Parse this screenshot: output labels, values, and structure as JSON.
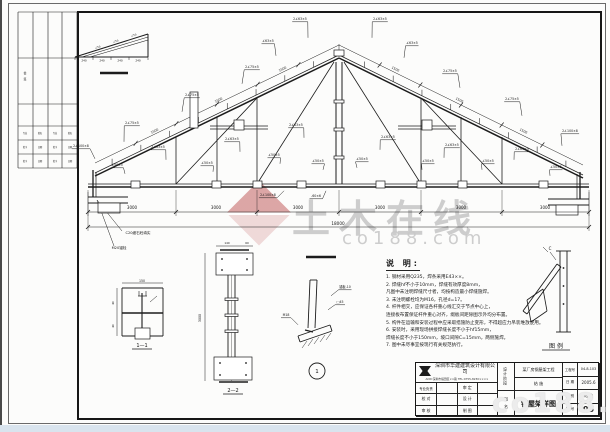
{
  "meta": {
    "sheet_no": "05",
    "drawing_title": "钢屋架详图",
    "source_watermark": "土木在线 co188.com"
  },
  "watermark": {
    "brand": "土木在线",
    "domain": "co188.com",
    "domain_bottom_right": "co188.com"
  },
  "notes": {
    "title": "说 明:",
    "lines": [
      "1. 钢材采用Q235，焊条采用E43××。",
      "2. 焊缝hf不小于10mm，焊缝有效厚度8mm，",
      "    凡图中未注明焊缝尺寸者，均按构造最小焊缝施焊。",
      "3. 未注明螺栓均为M16，孔径d=17。",
      "4. 杆件相交，应保证各杆重心线汇交于节点中心上，",
      "    连接板布置保证杆件重心对齐，缀板间距除图示外均分布置。",
      "5. 构件在运输和安装过程中应采取措施防止变形，不得超应力吊装堆放使用。",
      "6. 安装时，采用现场拼接焊缝长度不小于hf15mm，",
      "    焊缝长度不小于150mm，坡口间隙C=15mm，两侧施焊。",
      "7. 图中未尽事宜按现行有关规范执行。"
    ]
  },
  "title_block": {
    "company_name": "深圳市华建建筑设计有限公司",
    "company_info": "ADD:深圳市福田区××路 TEL:0755-8230××××",
    "roles": {
      "r0c0": "专业负责",
      "r0c1": "审 定",
      "r1c0": "校 对",
      "r1c1": "设 计",
      "r2c0": "审 核",
      "r2c1": "制 图"
    },
    "stage_label": "设计阶段",
    "name_label": "图 名",
    "project_name": "某厂房钢屋架工程",
    "stage_value": "结 施",
    "drawing_title": "钢屋架详图",
    "project_no_label": "工程号",
    "project_no": "04-8-103",
    "date_label": "日 期",
    "date": "2005.6",
    "category_label": "图 别",
    "category": "结 施",
    "sheet_label": "图 号",
    "sheet_no": "05"
  },
  "drawing": {
    "stroke": "#1c1c1c",
    "truss": {
      "apex": [
        339,
        58
      ],
      "eave_left": [
        95,
        176
      ],
      "eave_right": [
        583,
        178
      ],
      "bottom_y": 184,
      "bottom_x1": 88,
      "bottom_x2": 589,
      "king_x": 339
    },
    "webs": [
      [
        176,
        184,
        176,
        137
      ],
      [
        257,
        184,
        257,
        98
      ],
      [
        217,
        184,
        217,
        117
      ],
      [
        176,
        184,
        257,
        98
      ],
      [
        257,
        184,
        334,
        62
      ],
      [
        421,
        184,
        421,
        98
      ],
      [
        502,
        184,
        502,
        137
      ],
      [
        461,
        184,
        461,
        117
      ],
      [
        502,
        184,
        421,
        98
      ],
      [
        421,
        184,
        344,
        62
      ]
    ],
    "king_lines": [
      [
        336,
        62,
        336,
        184
      ],
      [
        342,
        62,
        342,
        184
      ]
    ],
    "extra_lines": [
      [
        88,
        197,
        128,
        197,
        1
      ],
      [
        88,
        203,
        128,
        203,
        1
      ],
      [
        93,
        170,
        93,
        197,
        1.3
      ],
      [
        96,
        172,
        96,
        197,
        0.7
      ],
      [
        548,
        199,
        589,
        199,
        1
      ],
      [
        548,
        205,
        589,
        205,
        1
      ],
      [
        580,
        172,
        580,
        199,
        1.3
      ],
      [
        577,
        174,
        577,
        199,
        0.7
      ],
      [
        210,
        126,
        268,
        126,
        0.7
      ],
      [
        210,
        129,
        268,
        129,
        0.7
      ],
      [
        398,
        126,
        456,
        126,
        0.7
      ],
      [
        398,
        129,
        456,
        129,
        0.7
      ],
      [
        100,
        73,
        128,
        73,
        2.6
      ],
      [
        306,
        257,
        336,
        257,
        2.6
      ],
      [
        339,
        44,
        339,
        57,
        0.5
      ],
      [
        97,
        200,
        122,
        231,
        0.5
      ],
      [
        97,
        200,
        114,
        246,
        0.5
      ],
      [
        75,
        57,
        148,
        57,
        1
      ],
      [
        148,
        34,
        148,
        57,
        1
      ],
      [
        75,
        57,
        148,
        34,
        1
      ],
      [
        82,
        57,
        148,
        37,
        0.55
      ],
      [
        90,
        57,
        148,
        40,
        0.55
      ],
      [
        75,
        57,
        75,
        60,
        0.5
      ],
      [
        93,
        57,
        93,
        60,
        0.5
      ],
      [
        111,
        57,
        111,
        60,
        0.5
      ],
      [
        129,
        57,
        129,
        60,
        0.5
      ],
      [
        148,
        57,
        148,
        60,
        0.5
      ],
      [
        122,
        288,
        163,
        288,
        0.9
      ],
      [
        163,
        288,
        163,
        336,
        0.9
      ],
      [
        122,
        336,
        163,
        336,
        0.9
      ],
      [
        122,
        288,
        122,
        336,
        0.9
      ],
      [
        142,
        293,
        142,
        336,
        1.1
      ],
      [
        122,
        313,
        163,
        313,
        1.6
      ],
      [
        139,
        291,
        139,
        296,
        0.6
      ],
      [
        146,
        291,
        146,
        296,
        0.6
      ],
      [
        138,
        296,
        147,
        296,
        0.7
      ],
      [
        150,
        302,
        157,
        296,
        0.5
      ],
      [
        122,
        283,
        163,
        283,
        0.5
      ],
      [
        117,
        288,
        117,
        336,
        0.5
      ],
      [
        220,
        250,
        249,
        250,
        1.6
      ],
      [
        219,
        382,
        248,
        382,
        1.6
      ],
      [
        228,
        275,
        228,
        357,
        0.9
      ],
      [
        235,
        275,
        235,
        357,
        0.9
      ],
      [
        231.5,
        253,
        231.5,
        381,
        0.35
      ],
      [
        205,
        253,
        205,
        381,
        0.5
      ],
      [
        216,
        246,
        253,
        246,
        0.5
      ],
      [
        310,
        280,
        308,
        328,
        0.9
      ],
      [
        317,
        280,
        315,
        328,
        0.9
      ],
      [
        310,
        280,
        317,
        280,
        0.9
      ],
      [
        298,
        336,
        330,
        325,
        0.9
      ],
      [
        300,
        342,
        332,
        331,
        0.9
      ],
      [
        298,
        336,
        300,
        342,
        0.9
      ],
      [
        330,
        325,
        332,
        331,
        0.9
      ],
      [
        305,
        330,
        313,
        332,
        1.3
      ],
      [
        302,
        348,
        307,
        341,
        0.45
      ],
      [
        308,
        346,
        313,
        339,
        0.45
      ],
      [
        314,
        344,
        319,
        337,
        0.45
      ],
      [
        320,
        342,
        325,
        335,
        0.45
      ],
      [
        326,
        340,
        331,
        333,
        0.45
      ],
      [
        560,
        251,
        560,
        332,
        0.9
      ],
      [
        567,
        251,
        567,
        332,
        0.9
      ],
      [
        556,
        251,
        571,
        251,
        0.9
      ],
      [
        556,
        332,
        571,
        332,
        0.9
      ],
      [
        523,
        311,
        557,
        264,
        0.9
      ],
      [
        527,
        314,
        561,
        267,
        0.9
      ],
      [
        523,
        311,
        527,
        314,
        0.9
      ],
      [
        557,
        264,
        561,
        267,
        0.9
      ],
      [
        527,
        300,
        543,
        289,
        0.8
      ],
      [
        531,
        322,
        547,
        311,
        0.8
      ],
      [
        527,
        300,
        531,
        322,
        0.8
      ],
      [
        543,
        289,
        547,
        311,
        0.8
      ],
      [
        550,
        252,
        556,
        260,
        0.5
      ],
      [
        543,
        247,
        548,
        252,
        0.5
      ],
      [
        192,
        92,
        192,
        126,
        0.5
      ]
    ],
    "rects": [
      [
        131,
        181,
        9,
        7
      ],
      [
        212,
        181,
        9,
        7
      ],
      [
        253,
        181,
        9,
        7
      ],
      [
        297,
        181,
        9,
        7
      ],
      [
        376,
        181,
        9,
        7
      ],
      [
        417,
        181,
        9,
        7
      ],
      [
        458,
        181,
        9,
        7
      ],
      [
        539,
        181,
        9,
        7
      ],
      [
        234,
        120,
        10,
        10
      ],
      [
        422,
        120,
        10,
        10
      ],
      [
        190,
        92,
        8,
        36
      ],
      [
        334,
        50,
        10,
        6
      ],
      [
        334,
        100,
        10,
        3
      ],
      [
        334,
        128,
        10,
        3
      ],
      [
        334,
        156,
        10,
        3
      ],
      [
        98,
        203,
        22,
        10
      ],
      [
        556,
        205,
        22,
        10
      ],
      [
        216,
        253,
        37,
        22
      ],
      [
        214,
        357,
        38,
        23
      ],
      [
        225,
        298,
        13,
        2.5
      ],
      [
        225,
        314,
        13,
        2.5
      ],
      [
        225,
        330,
        13,
        2.5
      ],
      [
        135,
        328,
        15,
        11
      ]
    ],
    "circles": [
      [
        222,
        259,
        0.9
      ],
      [
        247,
        259,
        0.9
      ],
      [
        222,
        270,
        0.9
      ],
      [
        247,
        270,
        0.9
      ],
      [
        220,
        363,
        0.9
      ],
      [
        246,
        363,
        0.9
      ],
      [
        220,
        375,
        0.9
      ],
      [
        246,
        375,
        0.9
      ],
      [
        563.5,
        268,
        0.9
      ],
      [
        563.5,
        286,
        0.9
      ],
      [
        563.5,
        304,
        0.9
      ]
    ],
    "bubble": {
      "x": 317,
      "y": 371,
      "r": 8,
      "t": "1"
    },
    "labels": [
      {
        "x": 81,
        "y": 147,
        "t": "2∠100×8",
        "dx": 14,
        "dy": 10
      },
      {
        "x": 132,
        "y": 124,
        "t": "2∠75×5",
        "dx": -8,
        "dy": 16
      },
      {
        "x": 192,
        "y": 96,
        "t": "2∠75×5",
        "dx": -10,
        "dy": 14
      },
      {
        "x": 252,
        "y": 68,
        "t": "2∠75×5",
        "dx": -10,
        "dy": 14
      },
      {
        "x": 268,
        "y": 42,
        "t": "∠63×5",
        "dx": 8,
        "dy": 12
      },
      {
        "x": 300,
        "y": 20,
        "t": "2∠63×5",
        "dx": 8,
        "dy": 16
      },
      {
        "x": 380,
        "y": 20,
        "t": "2∠63×5",
        "dx": -8,
        "dy": 16
      },
      {
        "x": 412,
        "y": 44,
        "t": "∠63×5",
        "dx": -8,
        "dy": 12
      },
      {
        "x": 450,
        "y": 72,
        "t": "2∠75×5",
        "dx": 10,
        "dy": 14
      },
      {
        "x": 512,
        "y": 100,
        "t": "2∠75×5",
        "dx": 10,
        "dy": 14
      },
      {
        "x": 570,
        "y": 132,
        "t": "2∠100×8",
        "dx": -8,
        "dy": 12
      },
      {
        "x": 117,
        "y": 166,
        "t": "∠50×5",
        "dx": 8,
        "dy": 6
      },
      {
        "x": 158,
        "y": 148,
        "t": "2∠63×5",
        "dx": 8,
        "dy": 10
      },
      {
        "x": 207,
        "y": 164,
        "t": "∠50×5",
        "dx": 6,
        "dy": 6
      },
      {
        "x": 232,
        "y": 140,
        "t": "2∠63×5",
        "dx": 8,
        "dy": 10
      },
      {
        "x": 274,
        "y": 156,
        "t": "∠50×5",
        "dx": 6,
        "dy": 6
      },
      {
        "x": 296,
        "y": 126,
        "t": "2∠63×5",
        "dx": 8,
        "dy": 10
      },
      {
        "x": 318,
        "y": 162,
        "t": "∠50×5",
        "dx": 5,
        "dy": 6
      },
      {
        "x": 362,
        "y": 160,
        "t": "∠50×5",
        "dx": -5,
        "dy": 6
      },
      {
        "x": 388,
        "y": 138,
        "t": "2∠63×5",
        "dx": -8,
        "dy": 10
      },
      {
        "x": 428,
        "y": 162,
        "t": "∠50×5",
        "dx": -6,
        "dy": 6
      },
      {
        "x": 452,
        "y": 146,
        "t": "2∠63×5",
        "dx": -8,
        "dy": 10
      },
      {
        "x": 488,
        "y": 162,
        "t": "∠50×5",
        "dx": -6,
        "dy": 6
      },
      {
        "x": 522,
        "y": 150,
        "t": "2∠63×5",
        "dx": -8,
        "dy": 8
      },
      {
        "x": 556,
        "y": 168,
        "t": "∠50×5",
        "dx": -6,
        "dy": 6
      },
      {
        "x": 268,
        "y": 196,
        "t": "2∠100×8",
        "dx": 16,
        "dy": -7
      },
      {
        "x": 316,
        "y": 197,
        "t": "-60×6",
        "dx": 10,
        "dy": -8
      },
      {
        "x": 345,
        "y": 288,
        "t": "锚板-10",
        "dx": -14,
        "dy": 6
      },
      {
        "x": 340,
        "y": 303,
        "t": "□45",
        "dx": -12,
        "dy": 5
      },
      {
        "x": 286,
        "y": 316,
        "t": "M18",
        "dx": 12,
        "dy": 7
      }
    ],
    "texts": [
      {
        "x": 132,
        "y": 209,
        "t": "3000",
        "s": 4
      },
      {
        "x": 216,
        "y": 209,
        "t": "3000",
        "s": 4
      },
      {
        "x": 298,
        "y": 209,
        "t": "3000",
        "s": 4
      },
      {
        "x": 380,
        "y": 209,
        "t": "3000",
        "s": 4
      },
      {
        "x": 461,
        "y": 209,
        "t": "3000",
        "s": 4
      },
      {
        "x": 545,
        "y": 209,
        "t": "3000",
        "s": 4
      },
      {
        "x": 338,
        "y": 225,
        "t": "18000",
        "s": 4.2
      },
      {
        "x": 155,
        "y": 132,
        "t": "1500",
        "s": 3.2,
        "r": -25.8
      },
      {
        "x": 219,
        "y": 101,
        "t": "1500",
        "s": 3.2,
        "r": -25.8
      },
      {
        "x": 283,
        "y": 70,
        "t": "1500",
        "s": 3.2,
        "r": -25.8
      },
      {
        "x": 395,
        "y": 70,
        "t": "1500",
        "s": 3.2,
        "r": 25.8
      },
      {
        "x": 459,
        "y": 101,
        "t": "1500",
        "s": 3.2,
        "r": 25.8
      },
      {
        "x": 523,
        "y": 132,
        "t": "1500",
        "s": 3.2,
        "r": 25.8
      },
      {
        "x": 84,
        "y": 61.5,
        "t": "240",
        "s": 2.8
      },
      {
        "x": 102,
        "y": 61.5,
        "t": "240",
        "s": 2.8
      },
      {
        "x": 120,
        "y": 61.5,
        "t": "240",
        "s": 2.8
      },
      {
        "x": 138,
        "y": 61.5,
        "t": "240",
        "s": 2.8
      },
      {
        "x": 98,
        "y": 48,
        "t": "∠50",
        "s": 2.5,
        "r": -17
      },
      {
        "x": 116,
        "y": 42,
        "t": "∠50",
        "s": 2.5,
        "r": -17
      },
      {
        "x": 134,
        "y": 36,
        "t": "∠50",
        "s": 2.5,
        "r": -17
      },
      {
        "x": 142,
        "y": 282,
        "t": "150",
        "s": 3.2
      },
      {
        "x": 114,
        "y": 303,
        "t": "40",
        "s": 2.8,
        "r": -90
      },
      {
        "x": 114,
        "y": 326,
        "t": "40",
        "s": 2.8,
        "r": -90
      },
      {
        "x": 142,
        "y": 347,
        "t": "1—1",
        "s": 5,
        "u": 20
      },
      {
        "x": 201,
        "y": 318,
        "t": "3000",
        "s": 3.2,
        "r": -90
      },
      {
        "x": 227,
        "y": 244,
        "t": "140",
        "s": 2.8
      },
      {
        "x": 247,
        "y": 244,
        "t": "60",
        "s": 2.8
      },
      {
        "x": 233,
        "y": 392,
        "t": "2—2",
        "s": 5,
        "u": 20
      },
      {
        "x": 556,
        "y": 348,
        "t": "图 例",
        "s": 6,
        "u": 28
      },
      {
        "x": 550,
        "y": 250,
        "t": "C",
        "s": 4
      },
      {
        "x": 138,
        "y": 234,
        "t": "C20细石砼填实",
        "s": 3.6
      },
      {
        "x": 119,
        "y": 249,
        "t": "M20锚栓",
        "s": 3.6
      }
    ],
    "dims": {
      "ticks": [
        88,
        176,
        257,
        339,
        421,
        502,
        589
      ],
      "row1_y": 212,
      "row2_y": 227
    },
    "sig_strip": {
      "cols": [
        18,
        33,
        48,
        62,
        77
      ],
      "rows": [
        12,
        58,
        104,
        126,
        140,
        154,
        168
      ],
      "texts": [
        {
          "x": 25,
          "y": 74,
          "t": "会",
          "s": 3
        },
        {
          "x": 25,
          "y": 80,
          "t": "签",
          "s": 3
        },
        {
          "x": 25,
          "y": 134,
          "t": "专业",
          "s": 2.2
        },
        {
          "x": 40,
          "y": 134,
          "t": "姓名",
          "s": 2.2
        },
        {
          "x": 55,
          "y": 134,
          "t": "专业",
          "s": 2.2
        },
        {
          "x": 70,
          "y": 134,
          "t": "姓名",
          "s": 2.2
        },
        {
          "x": 25,
          "y": 148,
          "t": "签字",
          "s": 2.2
        },
        {
          "x": 40,
          "y": 148,
          "t": "日期",
          "s": 2.2
        },
        {
          "x": 55,
          "y": 148,
          "t": "签字",
          "s": 2.2
        },
        {
          "x": 70,
          "y": 148,
          "t": "日期",
          "s": 2.2
        },
        {
          "x": 25,
          "y": 162,
          "t": "签字",
          "s": 2.2
        },
        {
          "x": 40,
          "y": 162,
          "t": "日期",
          "s": 2.2
        },
        {
          "x": 55,
          "y": 162,
          "t": "签字",
          "s": 2.2
        },
        {
          "x": 70,
          "y": 162,
          "t": "日期",
          "s": 2.2
        }
      ]
    }
  }
}
